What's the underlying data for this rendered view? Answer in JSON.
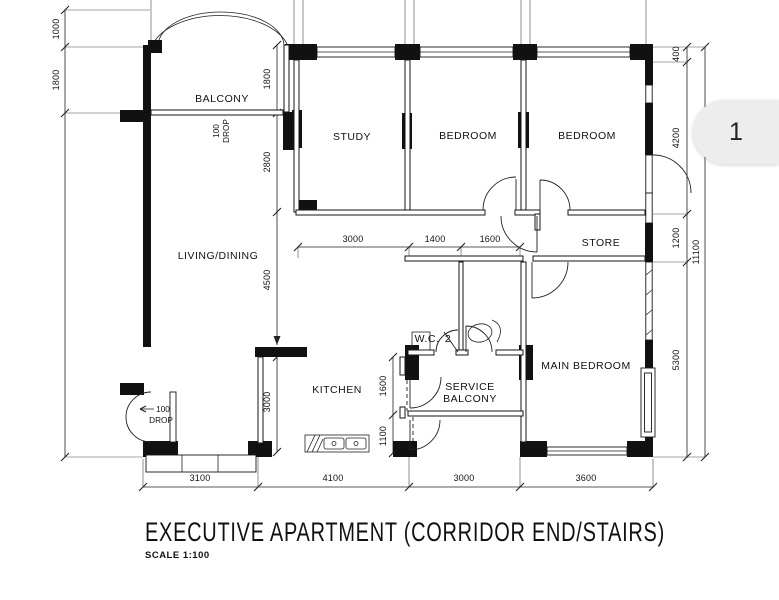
{
  "title": {
    "main": "EXECUTIVE APARTMENT (CORRIDOR END/STAIRS)",
    "scale": "SCALE 1:100"
  },
  "page_indicator": {
    "label": "1"
  },
  "rooms": {
    "balcony": "BALCONY",
    "study": "STUDY",
    "bedroom_top_middle": "BEDROOM",
    "bedroom_top_right": "BEDROOM",
    "living_dining": "LIVING/DINING",
    "store": "STORE",
    "main_bedroom": "MAIN BEDROOM",
    "kitchen": "KITCHEN",
    "service_balcony_line1": "SERVICE",
    "service_balcony_line2": "BALCONY",
    "wc_label": "W.C.",
    "wc_number": "2"
  },
  "annotations": {
    "balcony_drop_value": "100",
    "balcony_drop_word": "DROP",
    "entrance_drop_value": "100",
    "entrance_drop_word": "DROP"
  },
  "dimensions": {
    "left_top": "1000",
    "left_upper": "1800",
    "balcony_height": "1800",
    "study_height": "2800",
    "dining_height": "4500",
    "kitchen_height": "3000",
    "top_width_living": "3000",
    "top_width_wc": "1400",
    "top_width_bath": "1600",
    "service_height": "1600",
    "service_lower": "1100",
    "right_1": "400",
    "right_2": "4200",
    "right_3": "1200",
    "right_4": "5300",
    "right_total": "11100",
    "bottom_1": "3100",
    "bottom_2": "4100",
    "bottom_3": "3000",
    "bottom_4": "3600"
  },
  "colors": {
    "wall": "#111111",
    "line": "#333333",
    "background": "#ffffff",
    "tab_background": "#ededed",
    "tab_text": "#222222"
  }
}
